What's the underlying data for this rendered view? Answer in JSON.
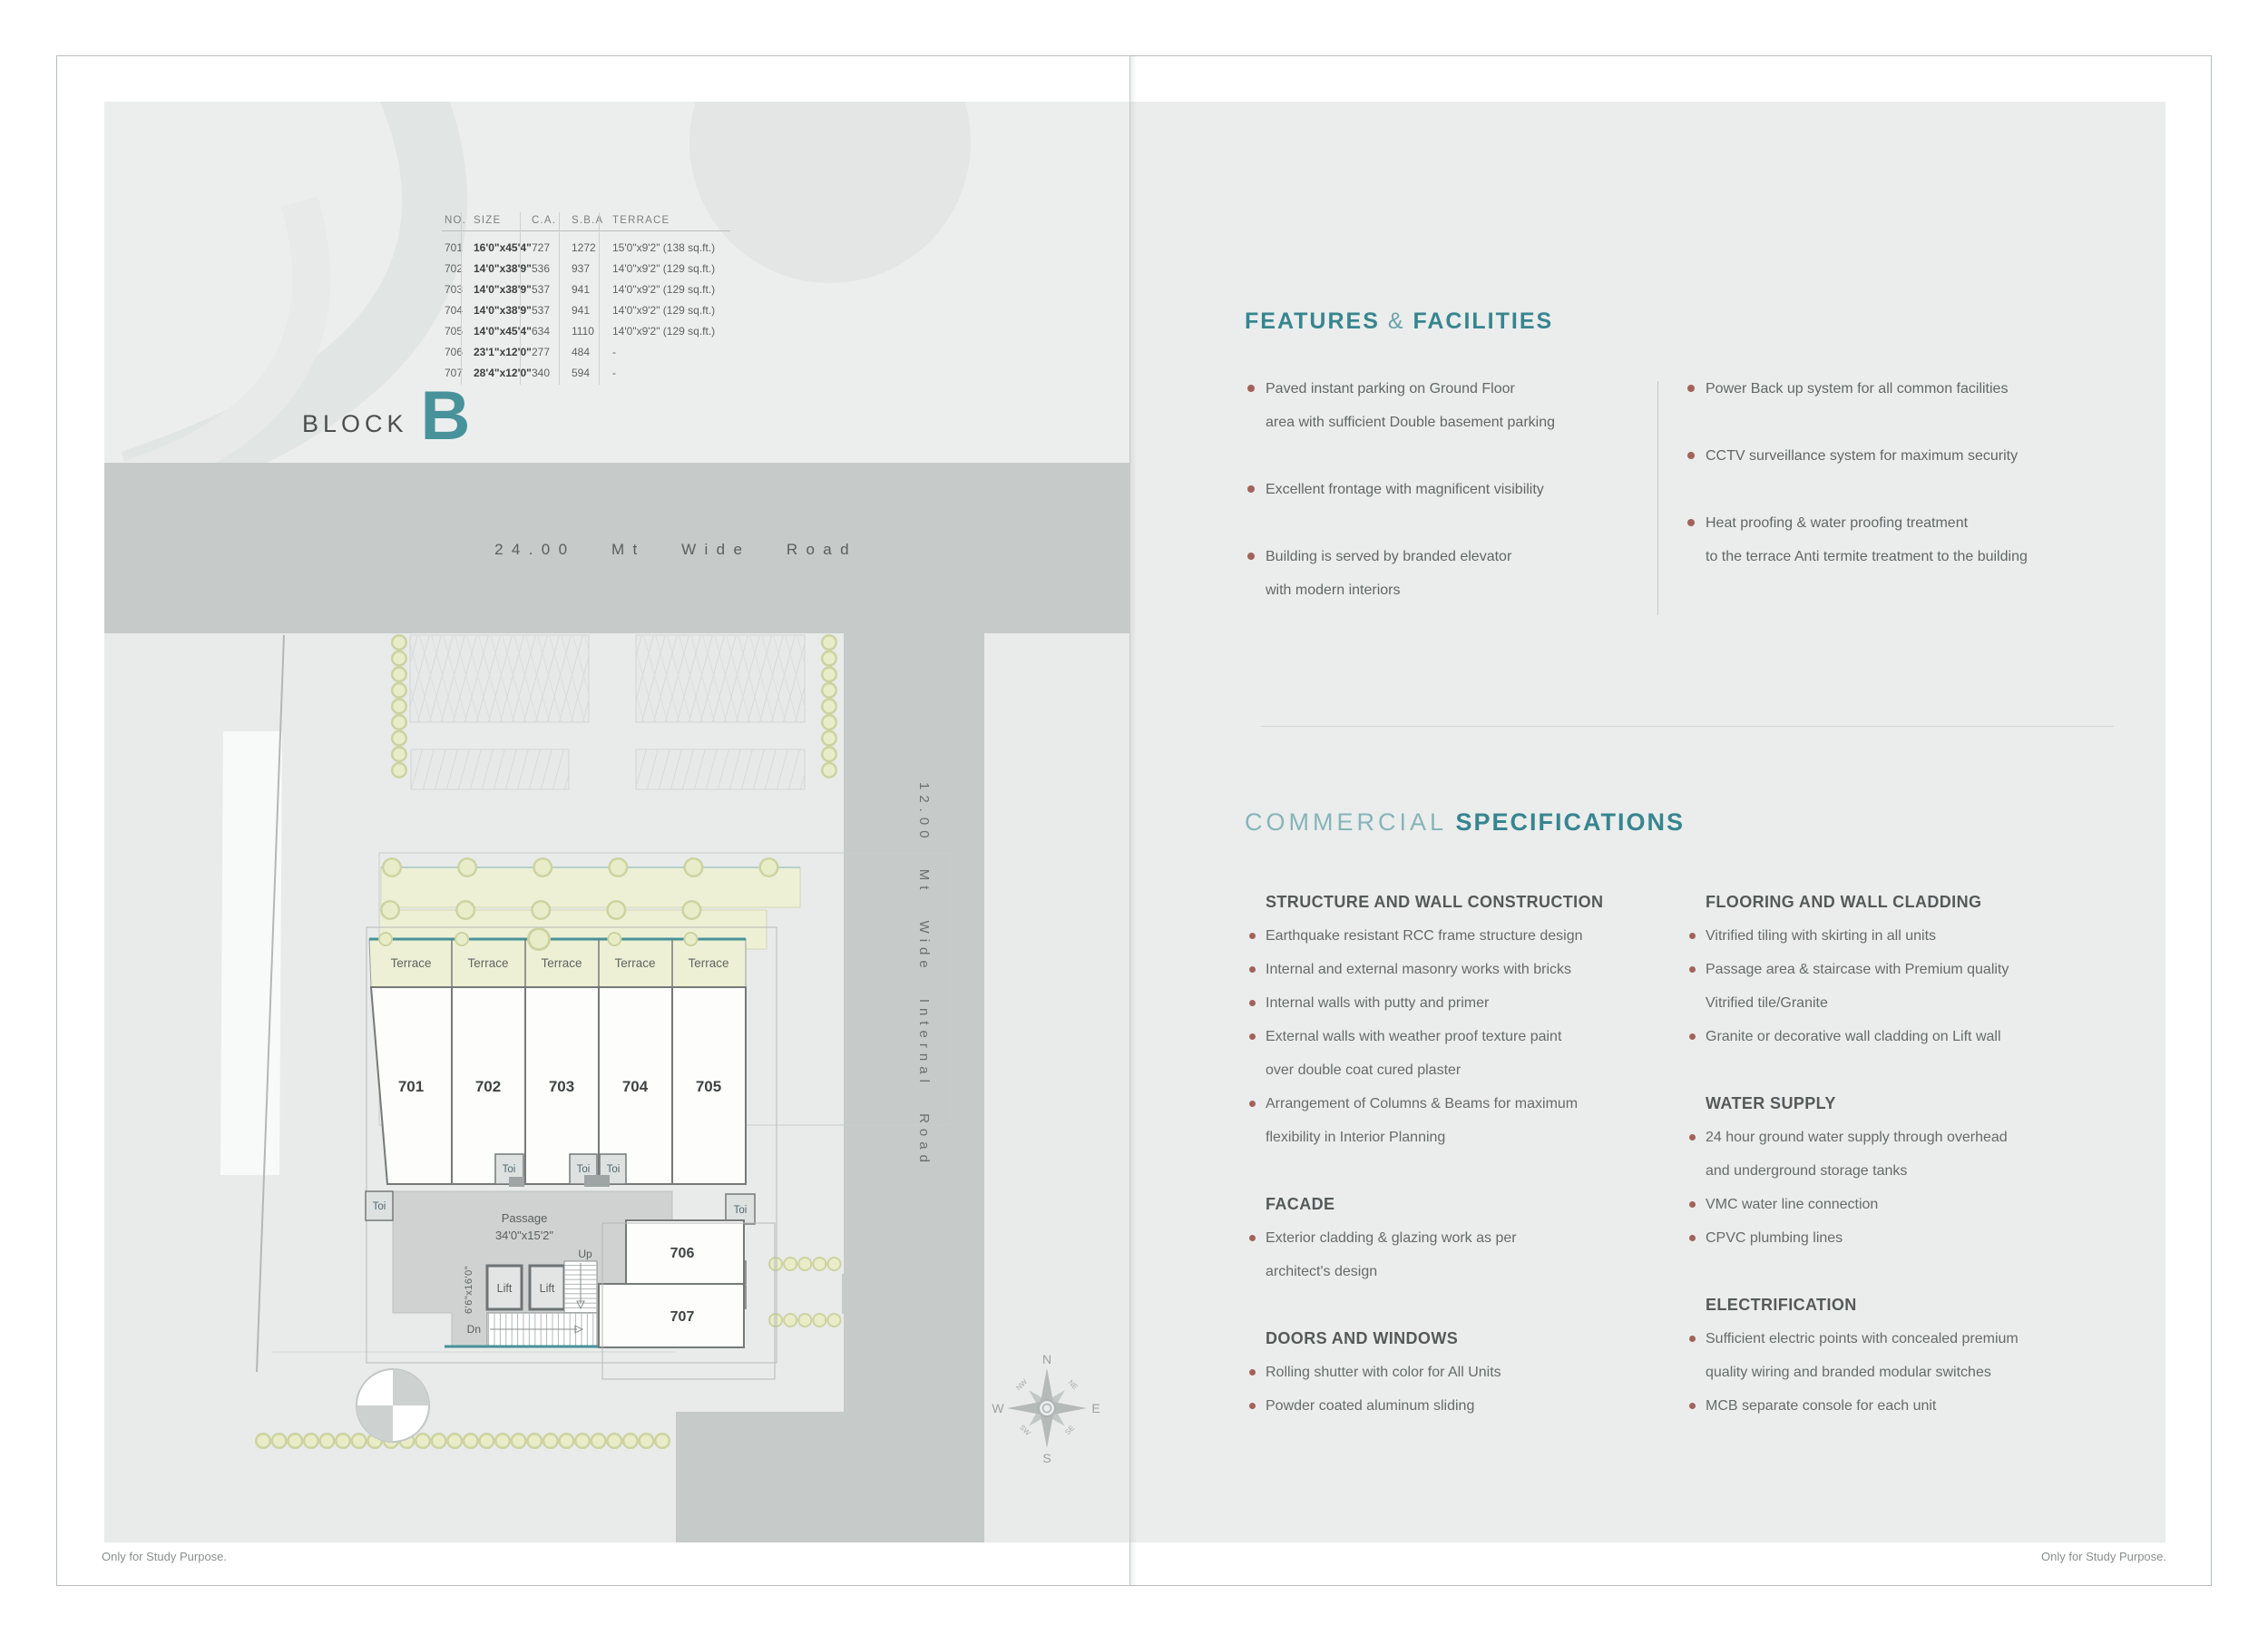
{
  "colors": {
    "teal_accent": "#48929b",
    "teal_light": "#87b4ba",
    "bullet_dot": "#a2625a",
    "road_gray": "#c6cac9",
    "panel_gray": "#eaedec",
    "plan_yellow": "#edf0d4",
    "wall_gray": "#757a79"
  },
  "page": {
    "left_footer": "Only for Study Purpose.",
    "right_footer": "Only for Study Purpose."
  },
  "block": {
    "label": "BLOCK",
    "letter": "B",
    "subtitle": "7th Floor Plan"
  },
  "table": {
    "headers": [
      "NO.",
      "SIZE",
      "C.A.",
      "S.B.A",
      "TERRACE"
    ],
    "rows": [
      {
        "no": "701",
        "size": "16'0\"x45'4\"",
        "ca": "727",
        "sba": "1272",
        "terrace": "15'0\"x9'2\" (138 sq.ft.)"
      },
      {
        "no": "702",
        "size": "14'0\"x38'9\"",
        "ca": "536",
        "sba": "937",
        "terrace": "14'0\"x9'2\" (129 sq.ft.)"
      },
      {
        "no": "703",
        "size": "14'0\"x38'9\"",
        "ca": "537",
        "sba": "941",
        "terrace": "14'0\"x9'2\" (129 sq.ft.)"
      },
      {
        "no": "704",
        "size": "14'0\"x38'9\"",
        "ca": "537",
        "sba": "941",
        "terrace": "14'0\"x9'2\" (129 sq.ft.)"
      },
      {
        "no": "705",
        "size": "14'0\"x45'4\"",
        "ca": "634",
        "sba": "1110",
        "terrace": "14'0\"x9'2\" (129 sq.ft.)"
      },
      {
        "no": "706",
        "size": "23'1\"x12'0\"",
        "ca": "277",
        "sba": "484",
        "terrace": "-"
      },
      {
        "no": "707",
        "size": "28'4\"x12'0\"",
        "ca": "340",
        "sba": "594",
        "terrace": "-"
      }
    ]
  },
  "roads": {
    "main": "24.00 Mt Wide Road",
    "internal": "12.00 Mt Wide Internal Road"
  },
  "plan": {
    "terrace_label": "Terrace",
    "toi_label": "Toi",
    "lift_label": "Lift",
    "passage_label": "Passage",
    "passage_size": "34'0\"x15'2\"",
    "stair_up": "Up",
    "stair_dn": "Dn",
    "stair_size": "6'6\"x16'0\"",
    "units": [
      "701",
      "702",
      "703",
      "704",
      "705",
      "706",
      "707"
    ],
    "compass": {
      "n": "N",
      "e": "E",
      "s": "S",
      "w": "W",
      "ne": "NE",
      "se": "SE",
      "sw": "SW",
      "nw": "NW"
    }
  },
  "features": {
    "title_main": "FEATURES",
    "title_amp": "&",
    "title_tail": "FACILITIES",
    "left": [
      [
        "Paved instant parking on Ground Floor",
        "area with sufficient Double basement parking"
      ],
      [
        "Excellent frontage with magnificent visibility"
      ],
      [
        "Building is served by branded elevator",
        "with modern interiors"
      ]
    ],
    "right": [
      [
        "Power Back up system for all common facilities"
      ],
      [
        "CCTV surveillance system for maximum security"
      ],
      [
        "Heat proofing & water proofing treatment",
        "to the terrace Anti termite treatment to the building"
      ]
    ]
  },
  "specs": {
    "title_light": "COMMERCIAL",
    "title_bold": "SPECIFICATIONS",
    "left": [
      {
        "heading": "STRUCTURE AND WALL CONSTRUCTION",
        "items": [
          [
            "Earthquake resistant RCC frame structure design"
          ],
          [
            "Internal and external masonry works with bricks"
          ],
          [
            "Internal walls with putty and primer"
          ],
          [
            "External walls with weather proof texture paint",
            "over double coat cured plaster"
          ],
          [
            "Arrangement of Columns & Beams for maximum",
            "flexibility in Interior Planning"
          ]
        ]
      },
      {
        "heading": "FACADE",
        "items": [
          [
            "Exterior cladding & glazing work as per",
            "architect's design"
          ]
        ]
      },
      {
        "heading": "DOORS AND WINDOWS",
        "items": [
          [
            "Rolling shutter with color for All Units"
          ],
          [
            "Powder coated aluminum sliding"
          ]
        ]
      }
    ],
    "right": [
      {
        "heading": "FLOORING AND WALL CLADDING",
        "items": [
          [
            "Vitrified tiling with skirting in all units"
          ],
          [
            "Passage area & staircase with Premium quality",
            "Vitrified tile/Granite"
          ],
          [
            "Granite or decorative wall cladding on Lift wall"
          ]
        ]
      },
      {
        "heading": "WATER SUPPLY",
        "items": [
          [
            "24 hour ground water supply through overhead",
            "and underground storage tanks"
          ],
          [
            "VMC water line connection"
          ],
          [
            "CPVC plumbing lines"
          ]
        ]
      },
      {
        "heading": "ELECTRIFICATION",
        "items": [
          [
            "Sufficient electric points with concealed premium",
            "quality wiring and branded modular switches"
          ],
          [
            "MCB separate console for each unit"
          ]
        ]
      }
    ]
  }
}
